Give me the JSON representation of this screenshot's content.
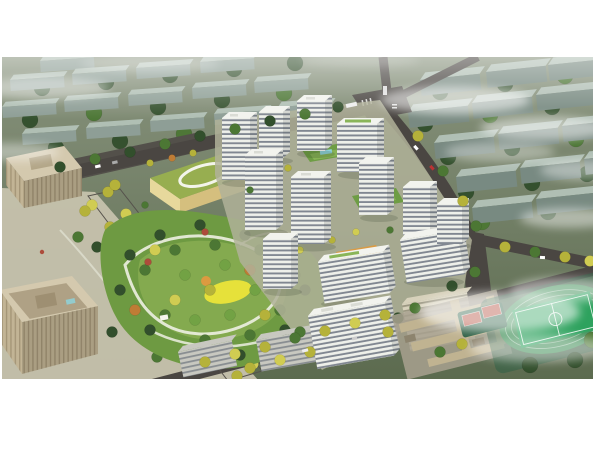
{
  "scene": {
    "type": "aerial-architectural-rendering",
    "description": "Bird's-eye architectural rendering of a residential masterplan: a cluster of white apartment towers with banded windows around landscaped courtyards, a large central park with winding white paths and a yellow playground, a kindergarten with a green roof and white loop, beige office towers and plaza to the west, a tree-lined boulevard with autumn-yellow trees, white and tan slab buildings to the south, a school campus with a green sports field and red courts to the southeast, muted grey-green context housing blocks to the north and east, dark roads with small vehicles, and soft white clouds drifting over the scene on a white page background.",
    "features": [
      "context-housing-blocks-north",
      "context-housing-blocks-east",
      "road-network",
      "parking-lot",
      "office-towers-west",
      "office-plaza",
      "kindergarten-green-roof",
      "central-park",
      "playground-yellow",
      "tree-lined-boulevard",
      "residential-tower-cluster",
      "courtyard-green-roofs",
      "swimming-pool",
      "south-slab-buildings",
      "school-campus",
      "running-track-and-pitch",
      "basketball-courts",
      "street-trees",
      "vehicles",
      "clouds"
    ]
  },
  "colors": {
    "page_bg": "#ffffff",
    "ground_top": "#87927c",
    "ground_bottom": "#5c6b4f",
    "site_paving": "#b0b299",
    "road": "#4a4642",
    "road_minor": "#56524c",
    "parking": "#53504a",
    "path_white": "#edefe2",
    "context_roof": "#b3c2b8",
    "context_face": "#8fa098",
    "context_face_dark": "#798b83",
    "tree_dark": "#324f2c",
    "tree_mid": "#4c7734",
    "tree_light": "#72a244",
    "tree_yellow": "#b5b23a",
    "tree_yellow_light": "#d0cc52",
    "tree_orange": "#bf7c35",
    "tree_red": "#ad4c3b",
    "park_base": "#6e9a42",
    "park_light": "#89ae52",
    "playground_yellow": "#e6e13a",
    "playground_orange": "#dc9a40",
    "tower_roof": "#f2f3ee",
    "tower_face": "#eef0ea",
    "tower_stripe": "#6d7581",
    "tower_side": "#d2d4cf",
    "tower_side_stripe": "#5e6672",
    "green_roof": "#6e9d44",
    "green_roof_light": "#8ab558",
    "pool_blue": "#8ed2d9",
    "office_roof": "#d4c9ae",
    "office_face": "#c2b495",
    "office_stripe": "#97886a",
    "office_ground": "#c6c2ad",
    "kg_roof": "#97ae50",
    "kg_wall": "#e7d89c",
    "kg_wall_dark": "#d5bf7e",
    "kg_loop": "#f3f4ea",
    "school_roof": "#c0b391",
    "school_dark": "#8d846e",
    "school_ground": "#a8a18f",
    "slab_grey": "#c8c8c0",
    "slab_tan": "#d7d1bb",
    "slab_tan_stripe": "#8b8773",
    "pitch_green": "#2ea25e",
    "track_green": "#43915a",
    "court_red": "#b24a38",
    "court_base": "#2f6146",
    "cloud": "#ffffff",
    "shadow": "#1f2a1b"
  }
}
